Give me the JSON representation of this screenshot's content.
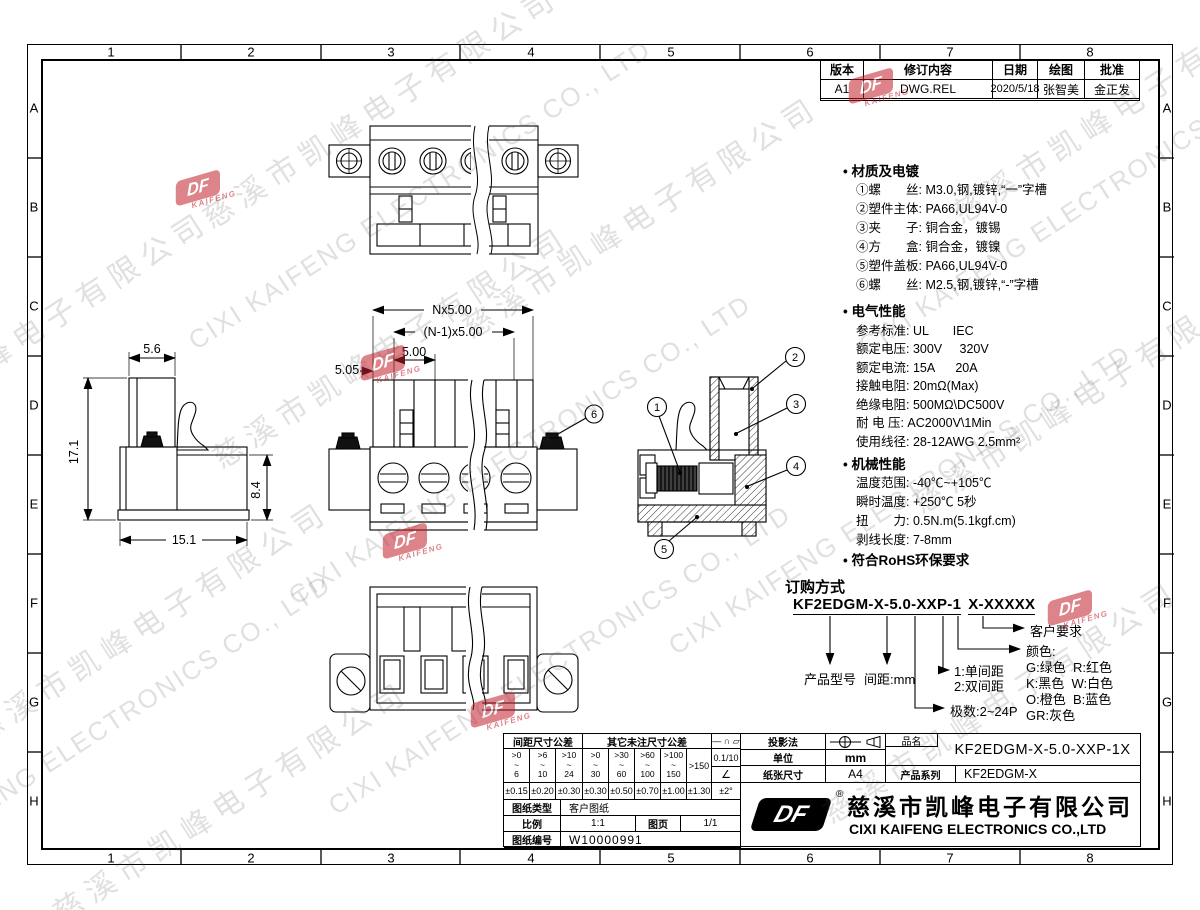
{
  "bullet": "•",
  "border": {
    "cols": [
      "1",
      "2",
      "3",
      "4",
      "5",
      "6",
      "7",
      "8"
    ],
    "rows": [
      "A",
      "B",
      "C",
      "D",
      "E",
      "F",
      "G",
      "H"
    ]
  },
  "revision": {
    "h": [
      "版本",
      "修订内容",
      "日期",
      "绘图",
      "批准"
    ],
    "r": [
      "A1",
      "DWG.REL",
      "2020/5/18",
      "张智美",
      "金正发"
    ]
  },
  "specs": {
    "material_title": "材质及电镀",
    "material_items": [
      "①螺　　丝: M3.0,钢,镀锌,“一”字槽",
      "②塑件主体: PA66,UL94V-0",
      "③夹　　子: 铜合金，镀锡",
      "④方　　盒: 铜合金，镀镍",
      "⑤塑件盖板: PA66,UL94V-0",
      "⑥螺　　丝: M2.5,钢,镀锌,“-”字槽"
    ],
    "electrical_title": "电气性能",
    "electrical_items": [
      "参考标准: UL       IEC",
      "额定电压: 300V     320V",
      "额定电流: 15A      20A",
      "接触电阻: 20mΩ(Max)",
      "绝缘电阻: 500MΩ\\DC500V",
      "耐 电 压: AC2000V\\1Min",
      "使用线径: 28-12AWG 2.5mm²"
    ],
    "mechanical_title": "机械性能",
    "mechanical_items": [
      "温度范围: -40℃~+105℃",
      "瞬时温度: +250℃ 5秒",
      "扭　　力: 0.5N.m(5.1kgf.cm)",
      "剥线长度: 7-8mm"
    ],
    "rohs": "符合RoHS环保要求"
  },
  "ordering": {
    "title": "订购方式",
    "pn_main": "KF2EDGM-X-5.0-XXP-1",
    "pn_suffix": "X-XXXXX",
    "product_model": "产品型号",
    "pitch": "间距:mm",
    "row1": "1:单间距",
    "row2": "2:双间距",
    "poles": "极数:2~24P",
    "color_title": "颜色:",
    "colors": [
      "G:绿色  R:红色",
      "K:黑色  W:白色",
      "O:橙色  B:蓝色",
      "GR:灰色"
    ],
    "customer": "客户要求"
  },
  "dims": {
    "side_top": "5.6",
    "side_h": "17.1",
    "side_r": "8.4",
    "side_w": "15.1",
    "front_total": "Nx5.00",
    "front_n1": "(N-1)x5.00",
    "front_pitch": "5.00",
    "front_first": "5.05"
  },
  "balloons": [
    "1",
    "2",
    "3",
    "4",
    "5",
    "6"
  ],
  "tol": {
    "pitch_header": "间距尺寸公差",
    "other_header": "其它未注尺寸公差",
    "ranges": [
      ">0\n~\n6",
      ">6\n~\n10",
      ">10\n~\n24",
      ">0\n~\n30",
      ">30\n~\n60",
      ">60\n~\n100",
      ">100\n~\n150"
    ],
    "range_last": ">150",
    "values": [
      "±0.15",
      "±0.20",
      "±0.30",
      "±0.30",
      "±0.50",
      "±0.70",
      "±1.00",
      "±1.30"
    ],
    "sym1": "— ∩ ▱",
    "sym2": "0.1/10",
    "sym3": "∠",
    "sym4": "±2°"
  },
  "titleblock": {
    "projection": "投影法",
    "unit_label": "单位",
    "unit": "mm",
    "paper_label": "纸张尺寸",
    "paper": "A4",
    "pn_label": "品名",
    "pn": "KF2EDGM-X-5.0-XXP-1X",
    "series_label": "产品系列",
    "series": "KF2EDGM-X",
    "type_label": "图纸类型",
    "type": "客户图纸",
    "scale_label": "比例",
    "scale": "1:1",
    "page_label": "图页",
    "page": "1/1",
    "no_label": "图纸编号",
    "no": "W10000991",
    "company_cn": "慈溪市凯峰电子有限公司",
    "company_en": "CIXI KAIFENG ELECTRONICS CO.,LTD",
    "reg": "®"
  },
  "watermark": {
    "cn": "慈溪市凯峰电子有限公司",
    "en": "CIXI KAIFENG ELECTRONICS CO., LTD",
    "logo": "DF",
    "logo_sub": "KAIFENG"
  }
}
